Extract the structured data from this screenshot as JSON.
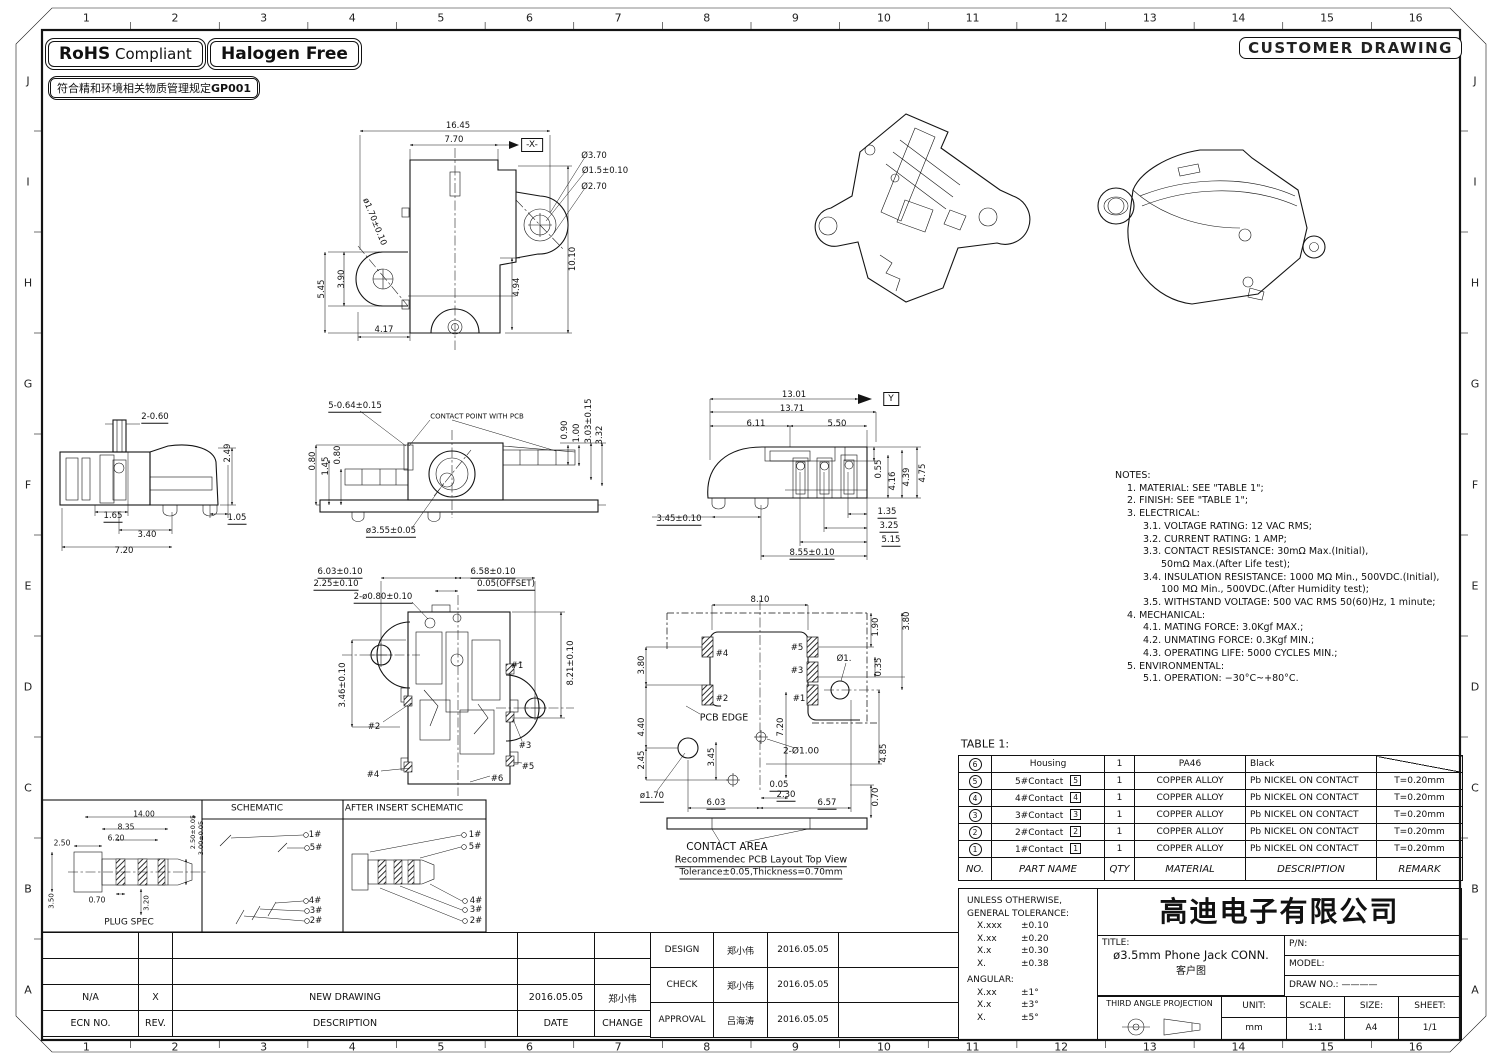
{
  "badges": {
    "rohs_bold": "RoHS",
    "rohs_rest": "Compliant",
    "halogen": "Halogen Free",
    "cn_note": "符合精和环境相关物质管理规定",
    "cn_note_bold": "GP001",
    "customer_drawing": "CUSTOMER DRAWING"
  },
  "border": {
    "cols": [
      "1",
      "2",
      "3",
      "4",
      "5",
      "6",
      "7",
      "8",
      "9",
      "10",
      "11",
      "12",
      "13",
      "14",
      "15",
      "16"
    ],
    "rows": [
      "J",
      "I",
      "H",
      "G",
      "F",
      "E",
      "D",
      "C",
      "B",
      "A"
    ]
  },
  "notes": {
    "lines": [
      {
        "i": 0,
        "t": "NOTES:"
      },
      {
        "i": 1,
        "t": "1. MATERIAL: SEE \"TABLE 1\";"
      },
      {
        "i": 1,
        "t": "2. FINISH: SEE \"TABLE 1\";"
      },
      {
        "i": 1,
        "t": "3. ELECTRICAL:"
      },
      {
        "i": 2,
        "t": "3.1. VOLTAGE RATING: 12 VAC RMS;"
      },
      {
        "i": 2,
        "t": "3.2. CURRENT RATING: 1 AMP;"
      },
      {
        "i": 2,
        "t": "3.3. CONTACT RESISTANCE: 30mΩ Max.(Initial),"
      },
      {
        "i": 3,
        "t": "50mΩ Max.(After Life test);"
      },
      {
        "i": 2,
        "t": "3.4. INSULATION RESISTANCE: 1000 MΩ Min., 500VDC.(Initial),"
      },
      {
        "i": 3,
        "t": "100 MΩ Min., 500VDC.(After Humidity test);"
      },
      {
        "i": 2,
        "t": "3.5. WITHSTAND VOLTAGE: 500 VAC RMS 50(60)Hz, 1 minute;"
      },
      {
        "i": 1,
        "t": "4. MECHANICAL:"
      },
      {
        "i": 2,
        "t": "4.1. MATING FORCE: 3.0Kgf MAX.;"
      },
      {
        "i": 2,
        "t": "4.2. UNMATING FORCE: 0.3Kgf MIN.;"
      },
      {
        "i": 2,
        "t": "4.3. OPERATING LIFE: 5000 CYCLES MIN.;"
      },
      {
        "i": 1,
        "t": "5. ENVIRONMENTAL:"
      },
      {
        "i": 2,
        "t": "5.1. OPERATION: −30°C~+80°C."
      }
    ]
  },
  "table1": {
    "title": "TABLE 1:",
    "headers": [
      "NO.",
      "PART NAME",
      "QTY",
      "MATERIAL",
      "DESCRIPTION",
      "REMARK"
    ],
    "rows": [
      {
        "no": "6",
        "name": "Housing",
        "tag": "",
        "qty": "1",
        "material": "PA46",
        "desc": "Black",
        "remark": "",
        "diag": true
      },
      {
        "no": "5",
        "name": "5#Contact",
        "tag": "5",
        "qty": "1",
        "material": "COPPER ALLOY",
        "desc": "Pb NICKEL ON CONTACT",
        "remark": "T=0.20mm"
      },
      {
        "no": "4",
        "name": "4#Contact",
        "tag": "4",
        "qty": "1",
        "material": "COPPER ALLOY",
        "desc": "Pb NICKEL ON CONTACT",
        "remark": "T=0.20mm"
      },
      {
        "no": "3",
        "name": "3#Contact",
        "tag": "3",
        "qty": "1",
        "material": "COPPER ALLOY",
        "desc": "Pb NICKEL ON CONTACT",
        "remark": "T=0.20mm"
      },
      {
        "no": "2",
        "name": "2#Contact",
        "tag": "2",
        "qty": "1",
        "material": "COPPER ALLOY",
        "desc": "Pb NICKEL ON CONTACT",
        "remark": "T=0.20mm"
      },
      {
        "no": "1",
        "name": "1#Contact",
        "tag": "1",
        "qty": "1",
        "material": "COPPER ALLOY",
        "desc": "Pb NICKEL ON CONTACT",
        "remark": "T=0.20mm"
      }
    ]
  },
  "tolerance": {
    "l1": "UNLESS OTHERWISE,",
    "l2": "GENERAL TOLERANCE:",
    "items": [
      [
        "X.xxx",
        "±0.10"
      ],
      [
        "X.xx",
        "±0.20"
      ],
      [
        "X.x",
        "±0.30"
      ],
      [
        "X.",
        "±0.38"
      ]
    ],
    "angular_label": "ANGULAR:",
    "angular": [
      [
        "X.xx",
        "±1°"
      ],
      [
        "X.x",
        "±3°"
      ],
      [
        "X.",
        "±5°"
      ]
    ]
  },
  "titleblock": {
    "company": "高迪电子有限公司",
    "title_label": "TITLE:",
    "title": "ø3.5mm  Phone  Jack  CONN.",
    "subtitle": "客户图",
    "pn_label": "P/N:",
    "model_label": "MODEL:",
    "drawno_label": "DRAW  NO.:",
    "drawno_value": "————",
    "projection": "THIRD ANGLE PROJECTION",
    "unit_label": "UNIT:",
    "unit": "mm",
    "scale_label": "SCALE:",
    "scale": "1:1",
    "size_label": "SIZE:",
    "size": "A4",
    "sheet_label": "SHEET:",
    "sheet": "1/1"
  },
  "revision": {
    "headers": [
      "ECN  NO.",
      "REV.",
      "DESCRIPTION",
      "DATE",
      "CHANGE"
    ],
    "rows": [
      [
        "",
        "",
        "",
        "",
        ""
      ],
      [
        "",
        "",
        "",
        "",
        ""
      ],
      [
        "N/A",
        "X",
        "NEW  DRAWING",
        "2016.05.05",
        "郑小伟"
      ]
    ]
  },
  "approval": {
    "rows": [
      [
        "DESIGN",
        "郑小伟",
        "2016.05.05"
      ],
      [
        "CHECK",
        "郑小伟",
        "2016.05.05"
      ],
      [
        "APPROVAL",
        "吕海涛",
        "2016.05.05"
      ]
    ]
  },
  "dims": [
    {
      "t": "16.45",
      "x": 458,
      "y": 126
    },
    {
      "t": "7.70",
      "x": 454,
      "y": 140
    },
    {
      "t": "-X-",
      "x": 532,
      "y": 145,
      "b": 1
    },
    {
      "t": "Ø3.70",
      "x": 594,
      "y": 156
    },
    {
      "t": "Ø1.5±0.10",
      "x": 605,
      "y": 171
    },
    {
      "t": "Ø2.70",
      "x": 594,
      "y": 187
    },
    {
      "t": "ø1.70±0.10",
      "x": 374,
      "y": 222,
      "r": 68
    },
    {
      "t": "5.45",
      "x": 322,
      "y": 289,
      "r": -90
    },
    {
      "t": "3.90",
      "x": 342,
      "y": 279,
      "r": -90
    },
    {
      "t": "4.17",
      "x": 384,
      "y": 330
    },
    {
      "t": "4.94",
      "x": 517,
      "y": 287,
      "r": -90
    },
    {
      "t": "10.10",
      "x": 573,
      "y": 259,
      "r": -90
    },
    {
      "t": "2-0.60",
      "x": 155,
      "y": 418,
      "u": 1
    },
    {
      "t": "2.49",
      "x": 228,
      "y": 453,
      "r": -90
    },
    {
      "t": "1.65",
      "x": 113,
      "y": 517,
      "u": 1
    },
    {
      "t": "3.40",
      "x": 147,
      "y": 535
    },
    {
      "t": "7.20",
      "x": 124,
      "y": 551
    },
    {
      "t": "1.05",
      "x": 237,
      "y": 519,
      "u": 1
    },
    {
      "t": "5-0.64±0.15",
      "x": 355,
      "y": 407,
      "u": 1
    },
    {
      "t": "CONTACT POINT WITH PCB",
      "x": 477,
      "y": 417,
      "s": 7
    },
    {
      "t": "0.80",
      "x": 313,
      "y": 461,
      "r": -90
    },
    {
      "t": "1.45",
      "x": 326,
      "y": 466,
      "r": -90
    },
    {
      "t": "0.80",
      "x": 338,
      "y": 455,
      "r": -90
    },
    {
      "t": "0.90",
      "x": 565,
      "y": 430,
      "r": -90
    },
    {
      "t": "1.00",
      "x": 577,
      "y": 433,
      "r": -90
    },
    {
      "t": "3.03±0.15",
      "x": 589,
      "y": 421,
      "r": -90
    },
    {
      "t": "3.32",
      "x": 600,
      "y": 435,
      "r": -90
    },
    {
      "t": "ø3.55±0.05",
      "x": 391,
      "y": 532,
      "u": 1
    },
    {
      "t": "13.01",
      "x": 794,
      "y": 395
    },
    {
      "t": "13.71",
      "x": 792,
      "y": 409
    },
    {
      "t": "6.11",
      "x": 756,
      "y": 424
    },
    {
      "t": "5.50",
      "x": 837,
      "y": 424
    },
    {
      "t": "Y",
      "x": 891,
      "y": 399,
      "b": 1
    },
    {
      "t": "0.55",
      "x": 879,
      "y": 469,
      "r": -90
    },
    {
      "t": "4.16",
      "x": 893,
      "y": 481,
      "r": -90
    },
    {
      "t": "4.39",
      "x": 907,
      "y": 477,
      "r": -90
    },
    {
      "t": "4.75",
      "x": 923,
      "y": 473,
      "r": -90
    },
    {
      "t": "3.45±0.10",
      "x": 679,
      "y": 520,
      "u": 1
    },
    {
      "t": "1.35",
      "x": 887,
      "y": 513,
      "u": 1
    },
    {
      "t": "3.25",
      "x": 889,
      "y": 527,
      "u": 1
    },
    {
      "t": "5.15",
      "x": 891,
      "y": 541,
      "u": 1
    },
    {
      "t": "8.55±0.10",
      "x": 812,
      "y": 554,
      "u": 1
    },
    {
      "t": "6.03±0.10",
      "x": 340,
      "y": 573,
      "u": 1
    },
    {
      "t": "2.25±0.10",
      "x": 336,
      "y": 585,
      "u": 1
    },
    {
      "t": "6.58±0.10",
      "x": 493,
      "y": 573,
      "u": 1
    },
    {
      "t": "0.05(OFFSET)",
      "x": 506,
      "y": 585,
      "u": 1
    },
    {
      "t": "2-ø0.80±0.10",
      "x": 383,
      "y": 598,
      "u": 1
    },
    {
      "t": "3.46±0.10",
      "x": 343,
      "y": 685,
      "r": -90
    },
    {
      "t": "8.21±0.10",
      "x": 571,
      "y": 663,
      "r": -90
    },
    {
      "t": "#1",
      "x": 517,
      "y": 666
    },
    {
      "t": "#2",
      "x": 374,
      "y": 727
    },
    {
      "t": "#3",
      "x": 525,
      "y": 746
    },
    {
      "t": "#4",
      "x": 373,
      "y": 775
    },
    {
      "t": "#5",
      "x": 528,
      "y": 767
    },
    {
      "t": "#6",
      "x": 497,
      "y": 779
    },
    {
      "t": "8.10",
      "x": 760,
      "y": 600
    },
    {
      "t": "1.90",
      "x": 876,
      "y": 627,
      "r": -90
    },
    {
      "t": "3.80",
      "x": 907,
      "y": 621,
      "r": -90
    },
    {
      "t": "#4",
      "x": 722,
      "y": 654
    },
    {
      "t": "#5",
      "x": 797,
      "y": 648
    },
    {
      "t": "Ø1.",
      "x": 844,
      "y": 659
    },
    {
      "t": "0.35",
      "x": 879,
      "y": 667,
      "r": -90
    },
    {
      "t": "#3",
      "x": 797,
      "y": 671
    },
    {
      "t": "3.80",
      "x": 642,
      "y": 665,
      "r": -90
    },
    {
      "t": "#2",
      "x": 722,
      "y": 699
    },
    {
      "t": "#1",
      "x": 799,
      "y": 699
    },
    {
      "t": "PCB EDGE",
      "x": 724,
      "y": 718,
      "s": 9.5
    },
    {
      "t": "4.40",
      "x": 642,
      "y": 727,
      "r": -90
    },
    {
      "t": "7.20",
      "x": 781,
      "y": 727,
      "r": -90
    },
    {
      "t": "2-Ø1.00",
      "x": 801,
      "y": 752,
      "s": 9
    },
    {
      "t": "4.85",
      "x": 884,
      "y": 753,
      "r": -90
    },
    {
      "t": "2.45",
      "x": 642,
      "y": 760,
      "r": -90
    },
    {
      "t": "3.45",
      "x": 712,
      "y": 757,
      "r": -90
    },
    {
      "t": "ø1.70",
      "x": 652,
      "y": 797,
      "u": 1
    },
    {
      "t": "6.03",
      "x": 716,
      "y": 804,
      "u": 1
    },
    {
      "t": "0.05",
      "x": 779,
      "y": 786,
      "u": 1
    },
    {
      "t": "2.30",
      "x": 786,
      "y": 796,
      "u": 1
    },
    {
      "t": "6.57",
      "x": 827,
      "y": 804,
      "u": 1
    },
    {
      "t": "0.70",
      "x": 876,
      "y": 797,
      "r": -90
    },
    {
      "t": "CONTACT AREA",
      "x": 727,
      "y": 847,
      "s": 10.5,
      "n": "contact-area-label"
    },
    {
      "t": "Recommendec PCB Layout Top View",
      "x": 761,
      "y": 861,
      "s": 9.5,
      "u": 1,
      "n": "pcb-layout-caption"
    },
    {
      "t": "Tolerance±0.05,Thickness=0.70mm",
      "x": 761,
      "y": 874,
      "s": 9,
      "u": 1,
      "n": "pcb-layout-tolerance"
    },
    {
      "t": "14.00",
      "x": 144,
      "y": 814,
      "s": 7.5
    },
    {
      "t": "8.35",
      "x": 126,
      "y": 827,
      "s": 7.5
    },
    {
      "t": "6.20",
      "x": 116,
      "y": 838,
      "s": 7.5
    },
    {
      "t": "2.50",
      "x": 62,
      "y": 843,
      "s": 7.5
    },
    {
      "t": "2.50±0.05",
      "x": 193,
      "y": 832,
      "r": -90,
      "s": 6.5
    },
    {
      "t": "3.00±0.05",
      "x": 201,
      "y": 838,
      "r": -90,
      "s": 6.5
    },
    {
      "t": "3.50",
      "x": 52,
      "y": 901,
      "r": -90,
      "s": 7
    },
    {
      "t": "0.70",
      "x": 97,
      "y": 900,
      "s": 7.5
    },
    {
      "t": "3.20",
      "x": 147,
      "y": 903,
      "r": -90,
      "s": 7
    },
    {
      "t": "PLUG  SPEC",
      "x": 129,
      "y": 923,
      "s": 9,
      "n": "plug-spec-label"
    },
    {
      "t": "SCHEMATIC",
      "x": 257,
      "y": 809,
      "s": 9,
      "n": "schematic-label"
    },
    {
      "t": "AFTER  INSERT  SCHEMATIC",
      "x": 404,
      "y": 809,
      "s": 9,
      "n": "after-insert-schematic-label"
    },
    {
      "t": "1#",
      "x": 315,
      "y": 835
    },
    {
      "t": "5#",
      "x": 316,
      "y": 848
    },
    {
      "t": "4#",
      "x": 315,
      "y": 901
    },
    {
      "t": "3#",
      "x": 316,
      "y": 911
    },
    {
      "t": "2#",
      "x": 316,
      "y": 921
    },
    {
      "t": "1#",
      "x": 475,
      "y": 835
    },
    {
      "t": "5#",
      "x": 475,
      "y": 847
    },
    {
      "t": "4#",
      "x": 476,
      "y": 901
    },
    {
      "t": "3#",
      "x": 476,
      "y": 910
    },
    {
      "t": "2#",
      "x": 476,
      "y": 921
    }
  ]
}
